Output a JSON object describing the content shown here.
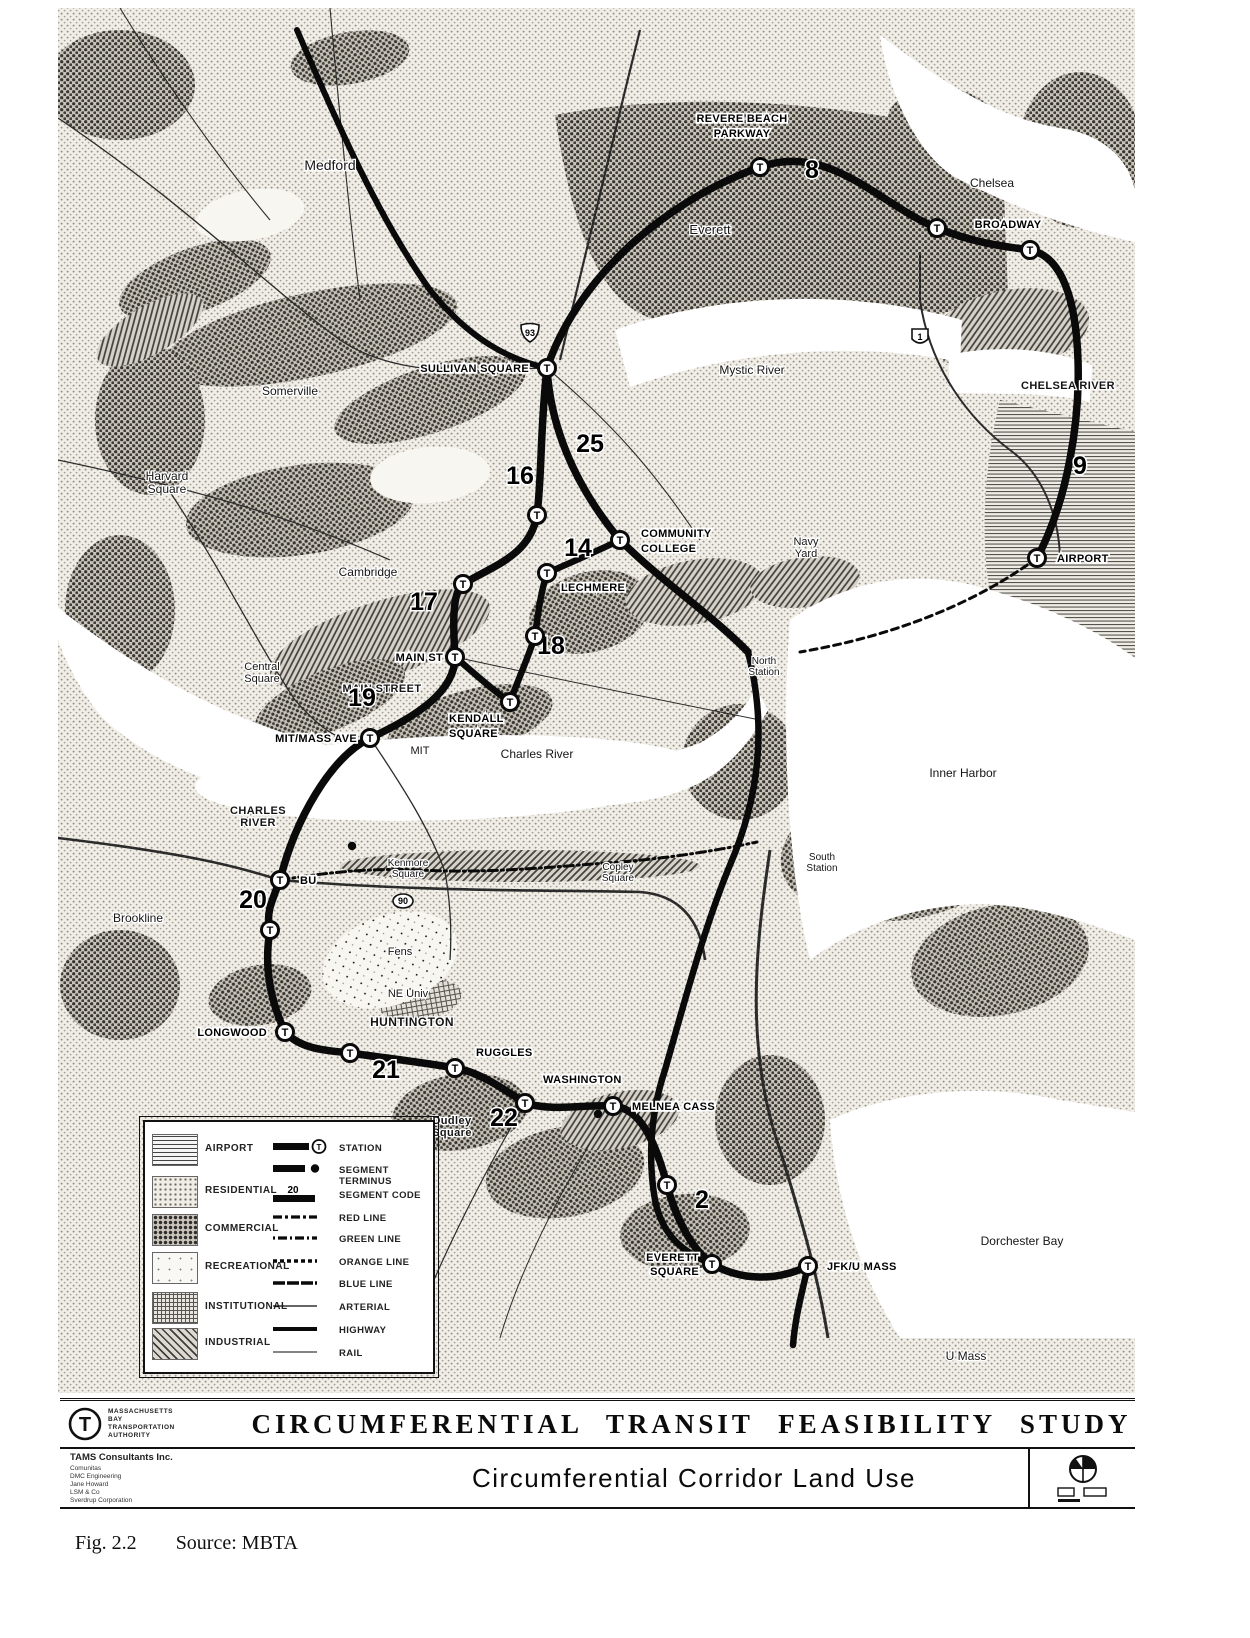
{
  "figure": {
    "study_title": "CIRCUMFERENTIAL TRANSIT FEASIBILITY STUDY",
    "map_title": "Circumferential Corridor Land Use",
    "caption_label": "Fig. 2.2",
    "caption_source": "Source: MBTA",
    "agency": {
      "logo_letter": "T",
      "name_lines": [
        "MASSACHUSETTS",
        "BAY",
        "TRANSPORTATION",
        "AUTHORITY"
      ]
    },
    "consultants": {
      "lead": "TAMS Consultants Inc.",
      "team": [
        "Comunitas",
        "DMC Engineering",
        "Jane Howard",
        "LSM & Co",
        "Sverdrup Corporation"
      ]
    },
    "colors": {
      "ink": "#0a0a0a",
      "paper": "#ffffff"
    }
  },
  "legend": {
    "land_use": [
      {
        "label": "AIRPORT",
        "pattern": "airport",
        "y": 28
      },
      {
        "label": "RESIDENTIAL",
        "pattern": "residential",
        "y": 70
      },
      {
        "label": "COMMERCIAL",
        "pattern": "commercial",
        "y": 108
      },
      {
        "label": "RECREATIONAL",
        "pattern": "recreational",
        "y": 146
      },
      {
        "label": "INSTITUTIONAL",
        "pattern": "institutional",
        "y": 186
      },
      {
        "label": "INDUSTRIAL",
        "pattern": "industrial",
        "y": 222
      }
    ],
    "symbols": [
      {
        "label": "STATION",
        "symbol": "station",
        "y": 26
      },
      {
        "label": "SEGMENT TERMINUS",
        "symbol": "terminus",
        "y": 48
      },
      {
        "label": "SEGMENT CODE",
        "symbol": "segment-code",
        "code": "20",
        "y": 73
      },
      {
        "label": "RED LINE",
        "symbol": "red-line",
        "y": 96
      },
      {
        "label": "GREEN LINE",
        "symbol": "green-line",
        "y": 117
      },
      {
        "label": "ORANGE LINE",
        "symbol": "orange-line",
        "y": 140
      },
      {
        "label": "BLUE LINE",
        "symbol": "blue-line",
        "y": 162
      },
      {
        "label": "ARTERIAL",
        "symbol": "arterial",
        "y": 185
      },
      {
        "label": "HIGHWAY",
        "symbol": "highway",
        "y": 208
      },
      {
        "label": "RAIL",
        "symbol": "rail",
        "y": 231
      }
    ]
  },
  "map": {
    "t_letter": "T",
    "stations": [
      {
        "name": "Revere Beach Parkway",
        "label_lines": [
          "REVERE BEACH",
          "PARKWAY"
        ],
        "x": 760,
        "y": 167,
        "lx": 742,
        "ly": 122,
        "anchor": "middle",
        "lh": 15
      },
      {
        "name": "",
        "label_lines": [],
        "x": 937,
        "y": 228
      },
      {
        "name": "Broadway",
        "label_lines": [
          "BROADWAY"
        ],
        "x": 1030,
        "y": 250,
        "lx": 1008,
        "ly": 228,
        "anchor": "middle"
      },
      {
        "name": "Sullivan Square",
        "label_lines": [
          "SULLIVAN SQUARE"
        ],
        "x": 547,
        "y": 368,
        "lx": 529,
        "ly": 372,
        "anchor": "end"
      },
      {
        "name": "Community College",
        "label_lines": [
          "COMMUNITY",
          "COLLEGE"
        ],
        "x": 620,
        "y": 540,
        "lx": 641,
        "ly": 537,
        "anchor": "start",
        "lh": 15
      },
      {
        "name": "Lechmere",
        "label_lines": [
          "LECHMERE"
        ],
        "x": 547,
        "y": 573,
        "lx": 561,
        "ly": 591,
        "anchor": "start"
      },
      {
        "name": "",
        "label_lines": [],
        "x": 537,
        "y": 515
      },
      {
        "name": "",
        "label_lines": [],
        "x": 463,
        "y": 584
      },
      {
        "name": "Main St",
        "label_lines": [
          "MAIN ST"
        ],
        "x": 455,
        "y": 657,
        "lx": 443,
        "ly": 661,
        "anchor": "end"
      },
      {
        "name": "",
        "label_lines": [],
        "x": 535,
        "y": 636
      },
      {
        "name": "Kendall Square",
        "label_lines": [
          "KENDALL",
          "SQUARE"
        ],
        "x": 510,
        "y": 702,
        "lx": 449,
        "ly": 722,
        "anchor": "start",
        "lh": 15
      },
      {
        "name": "MIT/Mass Ave",
        "label_lines": [
          "MIT/MASS AVE"
        ],
        "x": 370,
        "y": 738,
        "lx": 357,
        "ly": 742,
        "anchor": "end"
      },
      {
        "name": "BU",
        "label_lines": [
          "BU"
        ],
        "x": 280,
        "y": 880,
        "lx": 300,
        "ly": 884,
        "anchor": "start"
      },
      {
        "name": "",
        "label_lines": [],
        "x": 270,
        "y": 930
      },
      {
        "name": "Longwood",
        "label_lines": [
          "LONGWOOD"
        ],
        "x": 285,
        "y": 1032,
        "lx": 267,
        "ly": 1036,
        "anchor": "end"
      },
      {
        "name": "",
        "label_lines": [],
        "x": 350,
        "y": 1053
      },
      {
        "name": "Ruggles",
        "label_lines": [
          "RUGGLES"
        ],
        "x": 455,
        "y": 1068,
        "lx": 476,
        "ly": 1056,
        "anchor": "start"
      },
      {
        "name": "Washington",
        "label_lines": [
          "WASHINGTON"
        ],
        "x": 525,
        "y": 1103,
        "lx": 543,
        "ly": 1083,
        "anchor": "start"
      },
      {
        "name": "Melnea Cass",
        "label_lines": [
          "MELNEA CASS"
        ],
        "x": 613,
        "y": 1106,
        "lx": 632,
        "ly": 1110,
        "anchor": "start"
      },
      {
        "name": "",
        "label_lines": [],
        "x": 667,
        "y": 1185
      },
      {
        "name": "Everett Square",
        "label_lines": [
          "EVERETT",
          "SQUARE"
        ],
        "x": 712,
        "y": 1264,
        "lx": 699,
        "ly": 1261,
        "anchor": "end",
        "lh": 14
      },
      {
        "name": "JFK/U Mass",
        "label_lines": [
          "JFK/U MASS"
        ],
        "x": 808,
        "y": 1266,
        "lx": 827,
        "ly": 1270,
        "anchor": "start"
      },
      {
        "name": "Airport",
        "label_lines": [
          "AIRPORT"
        ],
        "x": 1037,
        "y": 558,
        "lx": 1057,
        "ly": 562,
        "anchor": "start"
      }
    ],
    "terminus_dots": [
      {
        "x": 598,
        "y": 1114
      },
      {
        "x": 352,
        "y": 846
      }
    ],
    "segment_codes": [
      {
        "code": "8",
        "x": 812,
        "y": 178
      },
      {
        "code": "9",
        "x": 1080,
        "y": 474
      },
      {
        "code": "25",
        "x": 590,
        "y": 452
      },
      {
        "code": "16",
        "x": 520,
        "y": 484
      },
      {
        "code": "14",
        "x": 578,
        "y": 556
      },
      {
        "code": "17",
        "x": 424,
        "y": 610
      },
      {
        "code": "18",
        "x": 551,
        "y": 654
      },
      {
        "code": "19",
        "x": 362,
        "y": 706
      },
      {
        "code": "20",
        "x": 253,
        "y": 908
      },
      {
        "code": "21",
        "x": 386,
        "y": 1078
      },
      {
        "code": "22",
        "x": 504,
        "y": 1126
      },
      {
        "code": "2",
        "x": 702,
        "y": 1208
      }
    ],
    "route_shields": [
      {
        "code": "93",
        "x": 530,
        "y": 333,
        "type": "interstate"
      },
      {
        "code": "1",
        "x": 920,
        "y": 337,
        "type": "us"
      },
      {
        "code": "90",
        "x": 403,
        "y": 901,
        "type": "pike"
      }
    ],
    "places": [
      {
        "text": "Medford",
        "x": 330,
        "y": 170,
        "size": 14
      },
      {
        "text": "Chelsea",
        "x": 992,
        "y": 187,
        "size": 12
      },
      {
        "text": "Everett",
        "x": 710,
        "y": 234,
        "size": 13
      },
      {
        "text": "Mystic River",
        "x": 752,
        "y": 374,
        "size": 12
      },
      {
        "text": "Somerville",
        "x": 290,
        "y": 395,
        "size": 12
      },
      {
        "lines": [
          "Harvard",
          "Square"
        ],
        "x": 167,
        "y": 480,
        "size": 12,
        "lh": 13
      },
      {
        "text": "Cambridge",
        "x": 368,
        "y": 576,
        "size": 12
      },
      {
        "lines": [
          "Central",
          "Square"
        ],
        "x": 262,
        "y": 670,
        "size": 11,
        "lh": 12
      },
      {
        "lines": [
          "Navy",
          "Yard"
        ],
        "x": 806,
        "y": 545,
        "size": 11,
        "lh": 12
      },
      {
        "text": "CHELSEA RIVER",
        "x": 1068,
        "y": 389,
        "size": 11,
        "bold": true
      },
      {
        "text": "Inner Harbor",
        "x": 963,
        "y": 777,
        "size": 12
      },
      {
        "text": "Charles River",
        "x": 537,
        "y": 758,
        "size": 12
      },
      {
        "lines": [
          "Kenmore",
          "Square"
        ],
        "x": 408,
        "y": 866,
        "size": 10,
        "lh": 11
      },
      {
        "lines": [
          "Copley",
          "Square"
        ],
        "x": 618,
        "y": 870,
        "size": 10,
        "lh": 11
      },
      {
        "lines": [
          "South",
          "Station"
        ],
        "x": 822,
        "y": 860,
        "size": 10,
        "lh": 11
      },
      {
        "lines": [
          "North",
          "Station"
        ],
        "x": 764,
        "y": 664,
        "size": 10,
        "lh": 11
      },
      {
        "text": "Brookline",
        "x": 138,
        "y": 922,
        "size": 12
      },
      {
        "text": "Fens",
        "x": 400,
        "y": 955,
        "size": 11
      },
      {
        "text": "NE Univ",
        "x": 408,
        "y": 997,
        "size": 11
      },
      {
        "lines": [
          "Dudley",
          "Square"
        ],
        "x": 452,
        "y": 1124,
        "size": 11,
        "lh": 12,
        "bold": true
      },
      {
        "text": "Dorchester Bay",
        "x": 1022,
        "y": 1245,
        "size": 12
      },
      {
        "text": "U Mass",
        "x": 966,
        "y": 1360,
        "size": 12
      },
      {
        "text": "MIT",
        "x": 420,
        "y": 754,
        "size": 11
      },
      {
        "text": "MAIN STREET",
        "x": 382,
        "y": 692,
        "size": 11,
        "bold": true
      },
      {
        "text": "HUNTINGTON",
        "x": 412,
        "y": 1026,
        "size": 12,
        "bold": true
      },
      {
        "lines": [
          "CHARLES",
          "RIVER"
        ],
        "x": 258,
        "y": 814,
        "size": 11,
        "lh": 12,
        "bold": true
      }
    ]
  }
}
